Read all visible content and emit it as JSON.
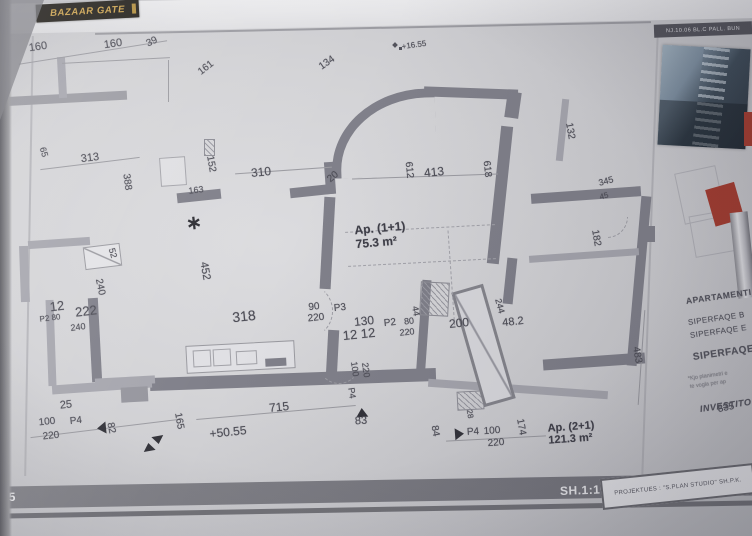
{
  "header": {
    "logo_text": "BAZAAR GATE",
    "right_bar_text": "NJ.10.06 BL.C PALL. BUN"
  },
  "title_block": {
    "heading": "APARTAMENTI",
    "line1": "SIPERFAQE B",
    "line2": "SIPERFAQE E",
    "line3": "SIPERFAQE",
    "note1": "*Kjo planimetri e",
    "note2": "te vogla per ap",
    "investor": "INVESTITO"
  },
  "footer": {
    "left_number": "55",
    "scale_label": "SH.1:100",
    "designer_label": "PROJEKTUES :  \"S.PLAN STUDIO\"  SH.P.K."
  },
  "plan": {
    "apartment1": {
      "name": "Ap. (1+1)",
      "area": "75.3 m²"
    },
    "apartment2": {
      "name": "Ap. (2+1)",
      "area": "121.3 m²"
    },
    "labels": [
      {
        "t": "160",
        "x": 38,
        "y": 47,
        "r": -8,
        "s": 11
      },
      {
        "t": "160",
        "x": 113,
        "y": 44,
        "r": -8,
        "s": 11
      },
      {
        "t": "39",
        "x": 152,
        "y": 42,
        "r": -25,
        "s": 10
      },
      {
        "t": "161",
        "x": 206,
        "y": 68,
        "r": -38,
        "s": 10
      },
      {
        "t": "134",
        "x": 327,
        "y": 63,
        "r": -35,
        "s": 10
      },
      {
        "t": "+16.55",
        "x": 414,
        "y": 45,
        "r": -8,
        "s": 8,
        "n": "level-label"
      },
      {
        "t": "313",
        "x": 90,
        "y": 158,
        "r": -7,
        "s": 11
      },
      {
        "t": "388",
        "x": 127,
        "y": 182,
        "r": 82,
        "s": 10
      },
      {
        "t": "65",
        "x": 44,
        "y": 152,
        "r": 75,
        "s": 9
      },
      {
        "t": "152",
        "x": 211,
        "y": 164,
        "r": 80,
        "s": 10
      },
      {
        "t": "310",
        "x": 261,
        "y": 172,
        "r": -6,
        "s": 12
      },
      {
        "t": "20",
        "x": 333,
        "y": 177,
        "r": -40,
        "s": 10
      },
      {
        "t": "163",
        "x": 196,
        "y": 190,
        "r": -7,
        "s": 9
      },
      {
        "t": "612",
        "x": 409,
        "y": 170,
        "r": 84,
        "s": 10
      },
      {
        "t": "413",
        "x": 434,
        "y": 172,
        "r": -6,
        "s": 12
      },
      {
        "t": "618",
        "x": 487,
        "y": 169,
        "r": 84,
        "s": 10
      },
      {
        "t": "132",
        "x": 570,
        "y": 131,
        "r": 80,
        "s": 10
      },
      {
        "t": "345",
        "x": 606,
        "y": 181,
        "r": -15,
        "s": 9
      },
      {
        "t": "45",
        "x": 604,
        "y": 196,
        "r": -15,
        "s": 8
      },
      {
        "t": "182",
        "x": 596,
        "y": 238,
        "r": 80,
        "s": 10
      },
      {
        "t": "52",
        "x": 113,
        "y": 253,
        "r": 75,
        "s": 9
      },
      {
        "t": "240",
        "x": 100,
        "y": 287,
        "r": 78,
        "s": 10
      },
      {
        "t": "222",
        "x": 86,
        "y": 311,
        "r": -7,
        "s": 13
      },
      {
        "t": "12",
        "x": 57,
        "y": 306,
        "r": -7,
        "s": 13
      },
      {
        "t": "P2 80",
        "x": 50,
        "y": 318,
        "r": -7,
        "s": 8,
        "n": "door-tag"
      },
      {
        "t": "240",
        "x": 78,
        "y": 327,
        "r": -7,
        "s": 9
      },
      {
        "t": "452",
        "x": 205,
        "y": 271,
        "r": 80,
        "s": 11
      },
      {
        "t": "318",
        "x": 244,
        "y": 316,
        "r": -6,
        "s": 14
      },
      {
        "t": "90",
        "x": 314,
        "y": 307,
        "r": -6,
        "s": 10
      },
      {
        "t": "220",
        "x": 316,
        "y": 318,
        "r": -6,
        "s": 10
      },
      {
        "t": "P3",
        "x": 340,
        "y": 308,
        "r": -6,
        "s": 10,
        "n": "door-tag"
      },
      {
        "t": "130",
        "x": 364,
        "y": 321,
        "r": -6,
        "s": 12
      },
      {
        "t": "12 12",
        "x": 359,
        "y": 334,
        "r": -6,
        "s": 13
      },
      {
        "t": "P2",
        "x": 390,
        "y": 323,
        "r": -6,
        "s": 10,
        "n": "door-tag"
      },
      {
        "t": "80",
        "x": 409,
        "y": 321,
        "r": -6,
        "s": 9
      },
      {
        "t": "220",
        "x": 407,
        "y": 332,
        "r": -6,
        "s": 9
      },
      {
        "t": "44",
        "x": 416,
        "y": 311,
        "r": 80,
        "s": 9
      },
      {
        "t": "200",
        "x": 459,
        "y": 323,
        "r": -6,
        "s": 12
      },
      {
        "t": "244",
        "x": 500,
        "y": 306,
        "r": 75,
        "s": 9
      },
      {
        "t": "48.2",
        "x": 513,
        "y": 322,
        "r": -6,
        "s": 11
      },
      {
        "t": "100",
        "x": 355,
        "y": 369,
        "r": 82,
        "s": 9
      },
      {
        "t": "220",
        "x": 366,
        "y": 370,
        "r": 82,
        "s": 9
      },
      {
        "t": "P4",
        "x": 352,
        "y": 393,
        "r": 82,
        "s": 9,
        "n": "door-tag"
      },
      {
        "t": "715",
        "x": 279,
        "y": 407,
        "r": -6,
        "s": 12
      },
      {
        "t": "83",
        "x": 361,
        "y": 421,
        "r": -4,
        "s": 11
      },
      {
        "t": "+50.55",
        "x": 228,
        "y": 432,
        "r": -6,
        "s": 12,
        "n": "level-label"
      },
      {
        "t": "25",
        "x": 66,
        "y": 405,
        "r": -6,
        "s": 11
      },
      {
        "t": "100",
        "x": 47,
        "y": 422,
        "r": -6,
        "s": 10
      },
      {
        "t": "220",
        "x": 51,
        "y": 436,
        "r": -6,
        "s": 10
      },
      {
        "t": "P4",
        "x": 76,
        "y": 421,
        "r": -6,
        "s": 10,
        "n": "door-tag"
      },
      {
        "t": "82",
        "x": 111,
        "y": 428,
        "r": 78,
        "s": 10
      },
      {
        "t": "165",
        "x": 179,
        "y": 421,
        "r": 80,
        "s": 10
      },
      {
        "t": "84",
        "x": 435,
        "y": 431,
        "r": 80,
        "s": 10
      },
      {
        "t": "P4",
        "x": 473,
        "y": 432,
        "r": -4,
        "s": 10,
        "n": "door-tag"
      },
      {
        "t": "100",
        "x": 492,
        "y": 431,
        "r": -4,
        "s": 10
      },
      {
        "t": "220",
        "x": 496,
        "y": 443,
        "r": -4,
        "s": 10
      },
      {
        "t": "174",
        "x": 521,
        "y": 427,
        "r": 80,
        "s": 10
      },
      {
        "t": "28",
        "x": 470,
        "y": 414,
        "r": 80,
        "s": 8
      },
      {
        "t": "483",
        "x": 637,
        "y": 355,
        "r": 80,
        "s": 10
      },
      {
        "t": "835",
        "x": 726,
        "y": 408,
        "r": -12,
        "s": 10
      }
    ]
  },
  "colors": {
    "wall": "#80808a",
    "paper": "#d3d3d6",
    "accent_red": "#a63b2e",
    "logo_bg": "#23201b",
    "logo_gold": "#cfa54f",
    "footer_bar": "#7a7a82"
  }
}
